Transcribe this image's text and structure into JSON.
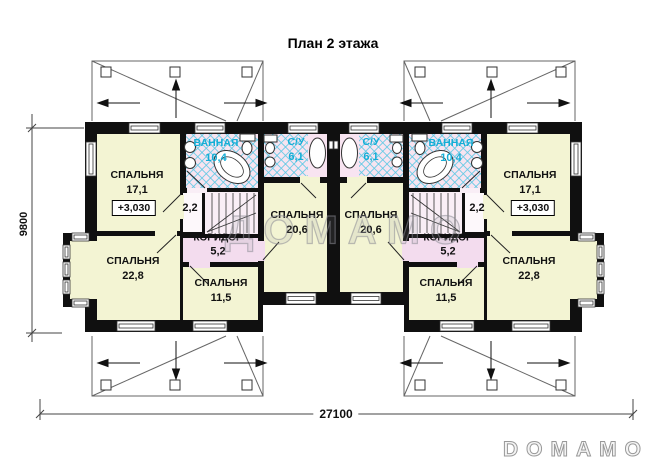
{
  "title": "План 2 этажа",
  "watermark": "ДОМАМО",
  "brand_logo": "DOMAMO",
  "dimensions": {
    "overall_width": "27100",
    "overall_depth": "9800"
  },
  "units": {
    "left": {
      "elevation_mark": "+3,030",
      "rooms": [
        {
          "name": "СПАЛЬНЯ",
          "area": "17,1"
        },
        {
          "name": "ВАННАЯ",
          "area": "10,4"
        },
        {
          "name": "С/У",
          "area": "6,1"
        },
        {
          "name": "",
          "area": "2,2"
        },
        {
          "name": "КОРИДОР",
          "area": "5,2"
        },
        {
          "name": "СПАЛЬНЯ",
          "area": "11,5"
        },
        {
          "name": "СПАЛЬНЯ",
          "area": "20,6"
        },
        {
          "name": "СПАЛЬНЯ",
          "area": "22,8"
        }
      ]
    },
    "right": {
      "elevation_mark": "+3,030",
      "rooms": [
        {
          "name": "СПАЛЬНЯ",
          "area": "17,1"
        },
        {
          "name": "ВАННАЯ",
          "area": "10,4"
        },
        {
          "name": "С/У",
          "area": "6,1"
        },
        {
          "name": "",
          "area": "2,2"
        },
        {
          "name": "КОРИДОР",
          "area": "5,2"
        },
        {
          "name": "СПАЛЬНЯ",
          "area": "11,5"
        },
        {
          "name": "СПАЛЬНЯ",
          "area": "20,6"
        },
        {
          "name": "СПАЛЬНЯ",
          "area": "22,8"
        }
      ]
    }
  },
  "colors": {
    "wall": "#101010",
    "room_fill": "#f3f4d3",
    "wet_room_fill": "#f7e4f0",
    "hatch_line": "#5ac8e4",
    "corridor_fill": "#f3dcee",
    "wet_label_accent": "#14aed6"
  }
}
